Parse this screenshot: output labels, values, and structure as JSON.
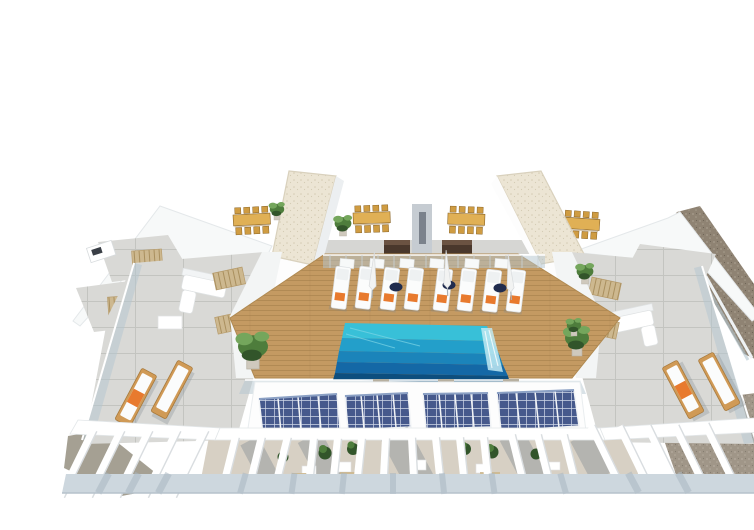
{
  "scene": {
    "description": "Aerial 3D architectural rendering of a residential building rooftop: central wooden pool deck with turquoise infinity pool and a row of white sun loungers, two white stair towers with gravel roofs, communal dining tables with wooden chairs, two dark outdoor kitchen cabinets, side concrete terraces with white lounge sofas, skylight grilles and timber sun beds with orange cushions, a front facade carrying four photovoltaic solar arrays, white pergola beams over private terraces below, potted plants, glass balustrades and a gravel party wall on the right.",
    "objects": {
      "stair_towers": 2,
      "dining_sets": 4,
      "kitchen_cabinets": 2,
      "pool": 1,
      "deck_sun_loungers": 8,
      "deck_side_tables": 3,
      "closed_parasols": 3,
      "wing_timber_loungers": 4,
      "lounge_sofas": 2,
      "skylight_grilles": 4,
      "solar_panel_arrays": 4,
      "pergola_beam_groups": 6,
      "potted_plants": 12
    }
  },
  "palette": {
    "white_wall": "#ffffff",
    "wall_shade": "#eceff1",
    "wall_shade_dark": "#d5dbdf",
    "roof_beige": "#ece5d4",
    "roof_dot": "#d5ccb4",
    "wood": "#c49a62",
    "wood_dark": "#9d7a46",
    "pool_1": "#38c0d8",
    "pool_2": "#239fca",
    "pool_3": "#1b84ba",
    "pool_4": "#1468a6",
    "pool_edge": "#0d4e7e",
    "waterfall": "#bfe9f2",
    "glass": "#b4c6cf",
    "concrete": "#d9d9d6",
    "concrete_line": "#c3c4c0",
    "tile_gray": "#cfcfcb",
    "mat_tan": "#cdb88f",
    "mat_line": "#a98f5e",
    "table_wood": "#e0b055",
    "chair_wood": "#cf9c42",
    "chair_dark": "#8a6426",
    "cabinet": "#4a382c",
    "cabinet_top": "#6b5342",
    "orange": "#e87a2e",
    "navy": "#202c4e",
    "plant": "#4e7d3c",
    "plant_light": "#74a65c",
    "plant_dark": "#32552a",
    "solar": "#46598c",
    "solar_light": "#8ba0c4",
    "solar_grid": "#dfe6f2",
    "gravel": "#8f8373",
    "gravel_light": "#a79d8c",
    "gravel_gray": "#a5a093",
    "ground": "#cdd7de",
    "ground_shadow": "#aab8c2",
    "shadow": "#7e8790",
    "floor_terrace": "#d7d0c4",
    "lounger_white": "#fbfcfc",
    "lounger_edge": "#d9dde0"
  }
}
